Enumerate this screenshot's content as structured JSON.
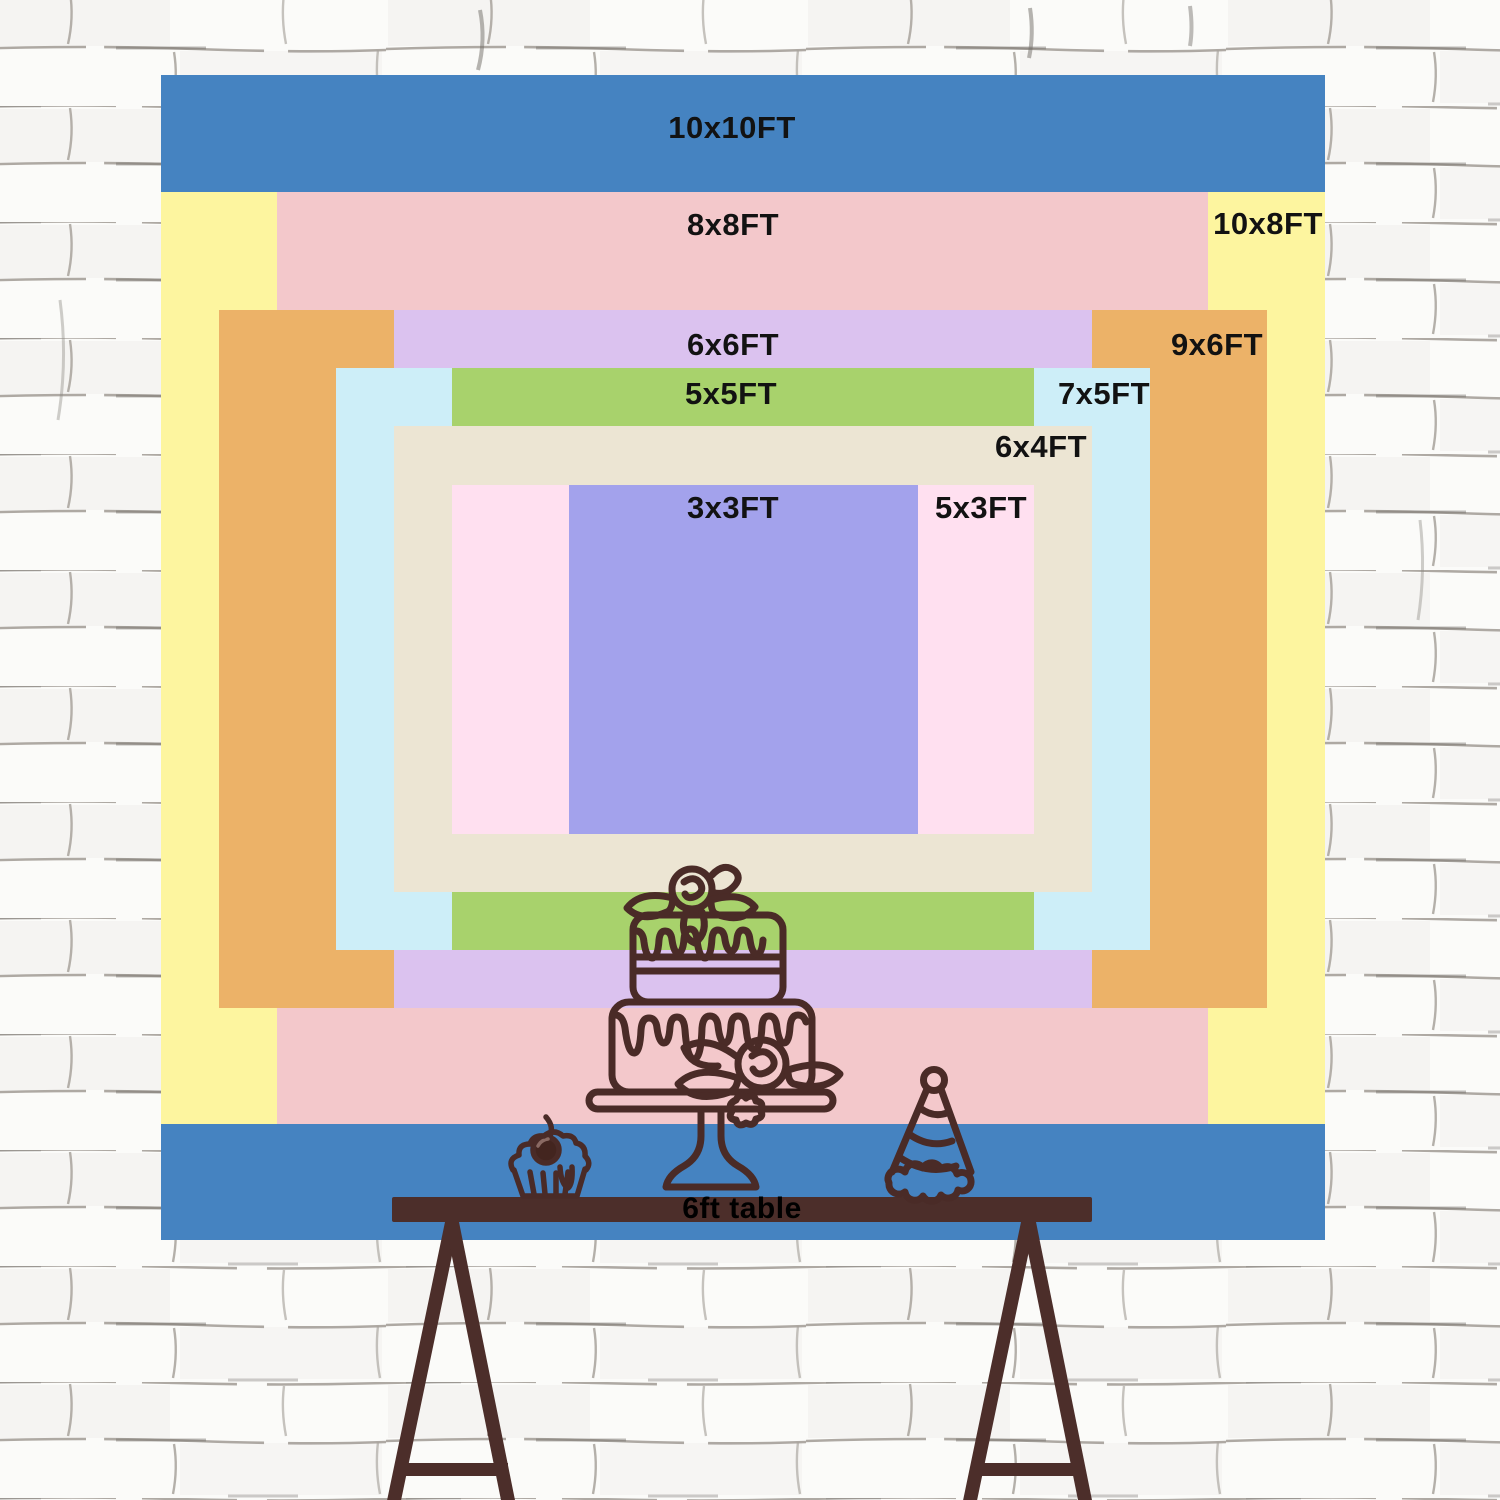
{
  "chart_data": {
    "type": "table",
    "title": "Backdrop size chart (feet)",
    "unit": "FT",
    "pixels_per_foot": 116.4,
    "sizes": [
      {
        "label": "10x10FT",
        "width_ft": 10,
        "height_ft": 10,
        "color": "#4583c1",
        "rect": [
          161,
          75,
          1164,
          1165
        ],
        "label_pos": [
          732,
          128
        ]
      },
      {
        "label": "10x8FT",
        "width_ft": 10,
        "height_ft": 8,
        "color": "#fdf59f",
        "rect": [
          161,
          192,
          1164,
          932
        ],
        "label_pos": [
          1268,
          224
        ]
      },
      {
        "label": "8x8FT",
        "width_ft": 8,
        "height_ft": 8,
        "color": "#f3c8cb",
        "rect": [
          277,
          192,
          931,
          932
        ],
        "label_pos": [
          733,
          225
        ]
      },
      {
        "label": "9x6FT",
        "width_ft": 9,
        "height_ft": 6,
        "color": "#ecb268",
        "rect": [
          219,
          310,
          1048,
          698
        ],
        "label_pos": [
          1217,
          345
        ]
      },
      {
        "label": "6x6FT",
        "width_ft": 6,
        "height_ft": 6,
        "color": "#dbc2ef",
        "rect": [
          394,
          310,
          698,
          698
        ],
        "label_pos": [
          733,
          345
        ]
      },
      {
        "label": "7x5FT",
        "width_ft": 7,
        "height_ft": 5,
        "color": "#cdeef8",
        "rect": [
          336,
          368,
          814,
          582
        ],
        "label_pos": [
          1104,
          394
        ]
      },
      {
        "label": "5x5FT",
        "width_ft": 5,
        "height_ft": 5,
        "color": "#a8d26c",
        "rect": [
          452,
          368,
          582,
          582
        ],
        "label_pos": [
          731,
          394
        ]
      },
      {
        "label": "6x4FT",
        "width_ft": 6,
        "height_ft": 4,
        "color": "#ece5d3",
        "rect": [
          394,
          426,
          698,
          466
        ],
        "label_pos": [
          1041,
          447
        ]
      },
      {
        "label": "5x3FT",
        "width_ft": 5,
        "height_ft": 3,
        "color": "#ffe0f0",
        "rect": [
          452,
          485,
          582,
          349
        ],
        "label_pos": [
          981,
          508
        ]
      },
      {
        "label": "3x3FT",
        "width_ft": 3,
        "height_ft": 3,
        "color": "#a3a2ec",
        "rect": [
          569,
          485,
          349,
          349
        ],
        "label_pos": [
          733,
          508
        ]
      }
    ]
  },
  "table": {
    "label": "6ft table",
    "label_pos": [
      742,
      1209
    ]
  },
  "illustrations": [
    "table-icon",
    "cake-icon",
    "cupcake-icon",
    "party-hat-icon"
  ],
  "palette": {
    "outline": "#4a2b27",
    "table_wood": "#4c2e2a",
    "label_text": "#121212",
    "wall_bg": "#fbfbf9",
    "wall_line": "#a5a09a"
  }
}
